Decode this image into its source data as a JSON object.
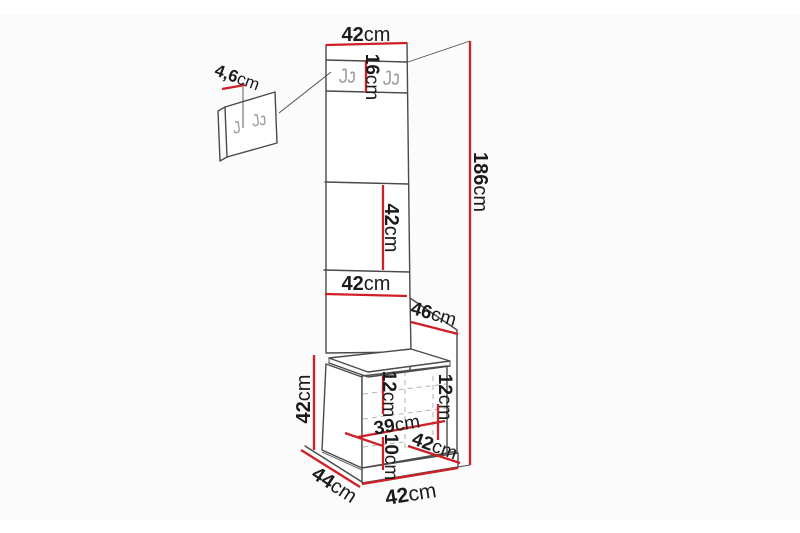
{
  "diagram": {
    "type": "furniture-dimension-diagram",
    "subject": "hallway panel with coat hooks and bench cabinet",
    "unit": "cm",
    "colors": {
      "dimension_line": "#d01f26",
      "outline": "#4a4a4a",
      "hook": "#9b9b9b",
      "text": "#1b1b1b",
      "canvas": "#fbfbfb"
    },
    "icons": {
      "coat_hook": "double-prong-hook"
    },
    "dims": {
      "panel_top_width": {
        "value": "42",
        "unit": "cm"
      },
      "hook_strip_height": {
        "value": "16",
        "unit": "cm"
      },
      "wall_panel_depth": {
        "value": "4,6",
        "unit": "cm"
      },
      "total_height": {
        "value": "186",
        "unit": "cm"
      },
      "mid_panel_height": {
        "value": "42",
        "unit": "cm"
      },
      "lower_panel_width": {
        "value": "42",
        "unit": "cm"
      },
      "side_panel_depth": {
        "value": "46",
        "unit": "cm"
      },
      "bench_height": {
        "value": "42",
        "unit": "cm"
      },
      "shelf_front_height": {
        "value": "12",
        "unit": "cm"
      },
      "shelf_side_height": {
        "value": "12",
        "unit": "cm"
      },
      "shelf_width": {
        "value": "39",
        "unit": "cm"
      },
      "plinth_height": {
        "value": "10",
        "unit": "cm"
      },
      "bench_depth_top": {
        "value": "42",
        "unit": "cm"
      },
      "bench_base_depth": {
        "value": "44",
        "unit": "cm"
      },
      "bench_base_width": {
        "value": "42",
        "unit": "cm"
      }
    }
  }
}
